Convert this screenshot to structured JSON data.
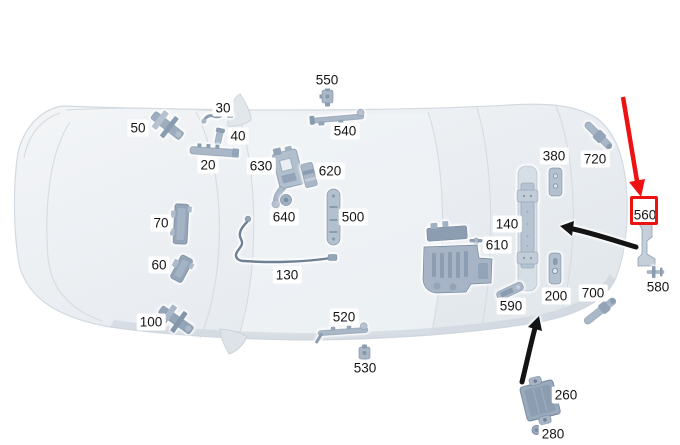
{
  "diagram": {
    "parts": [
      {
        "label": "50"
      },
      {
        "label": "30"
      },
      {
        "label": "40"
      },
      {
        "label": "20"
      },
      {
        "label": "550"
      },
      {
        "label": "540"
      },
      {
        "label": "630"
      },
      {
        "label": "620"
      },
      {
        "label": "640"
      },
      {
        "label": "500"
      },
      {
        "label": "70"
      },
      {
        "label": "60"
      },
      {
        "label": "130"
      },
      {
        "label": "100"
      },
      {
        "label": "520"
      },
      {
        "label": "530"
      },
      {
        "label": "140"
      },
      {
        "label": "610"
      },
      {
        "label": "590"
      },
      {
        "label": "200"
      },
      {
        "label": "700"
      },
      {
        "label": "380"
      },
      {
        "label": "720"
      },
      {
        "label": "560"
      },
      {
        "label": "580"
      },
      {
        "label": "260"
      },
      {
        "label": "280"
      }
    ],
    "annotations": {
      "highlighted_part": "560",
      "highlight_color": "#ee1111",
      "pointer_arrow_color": "#141414"
    }
  }
}
